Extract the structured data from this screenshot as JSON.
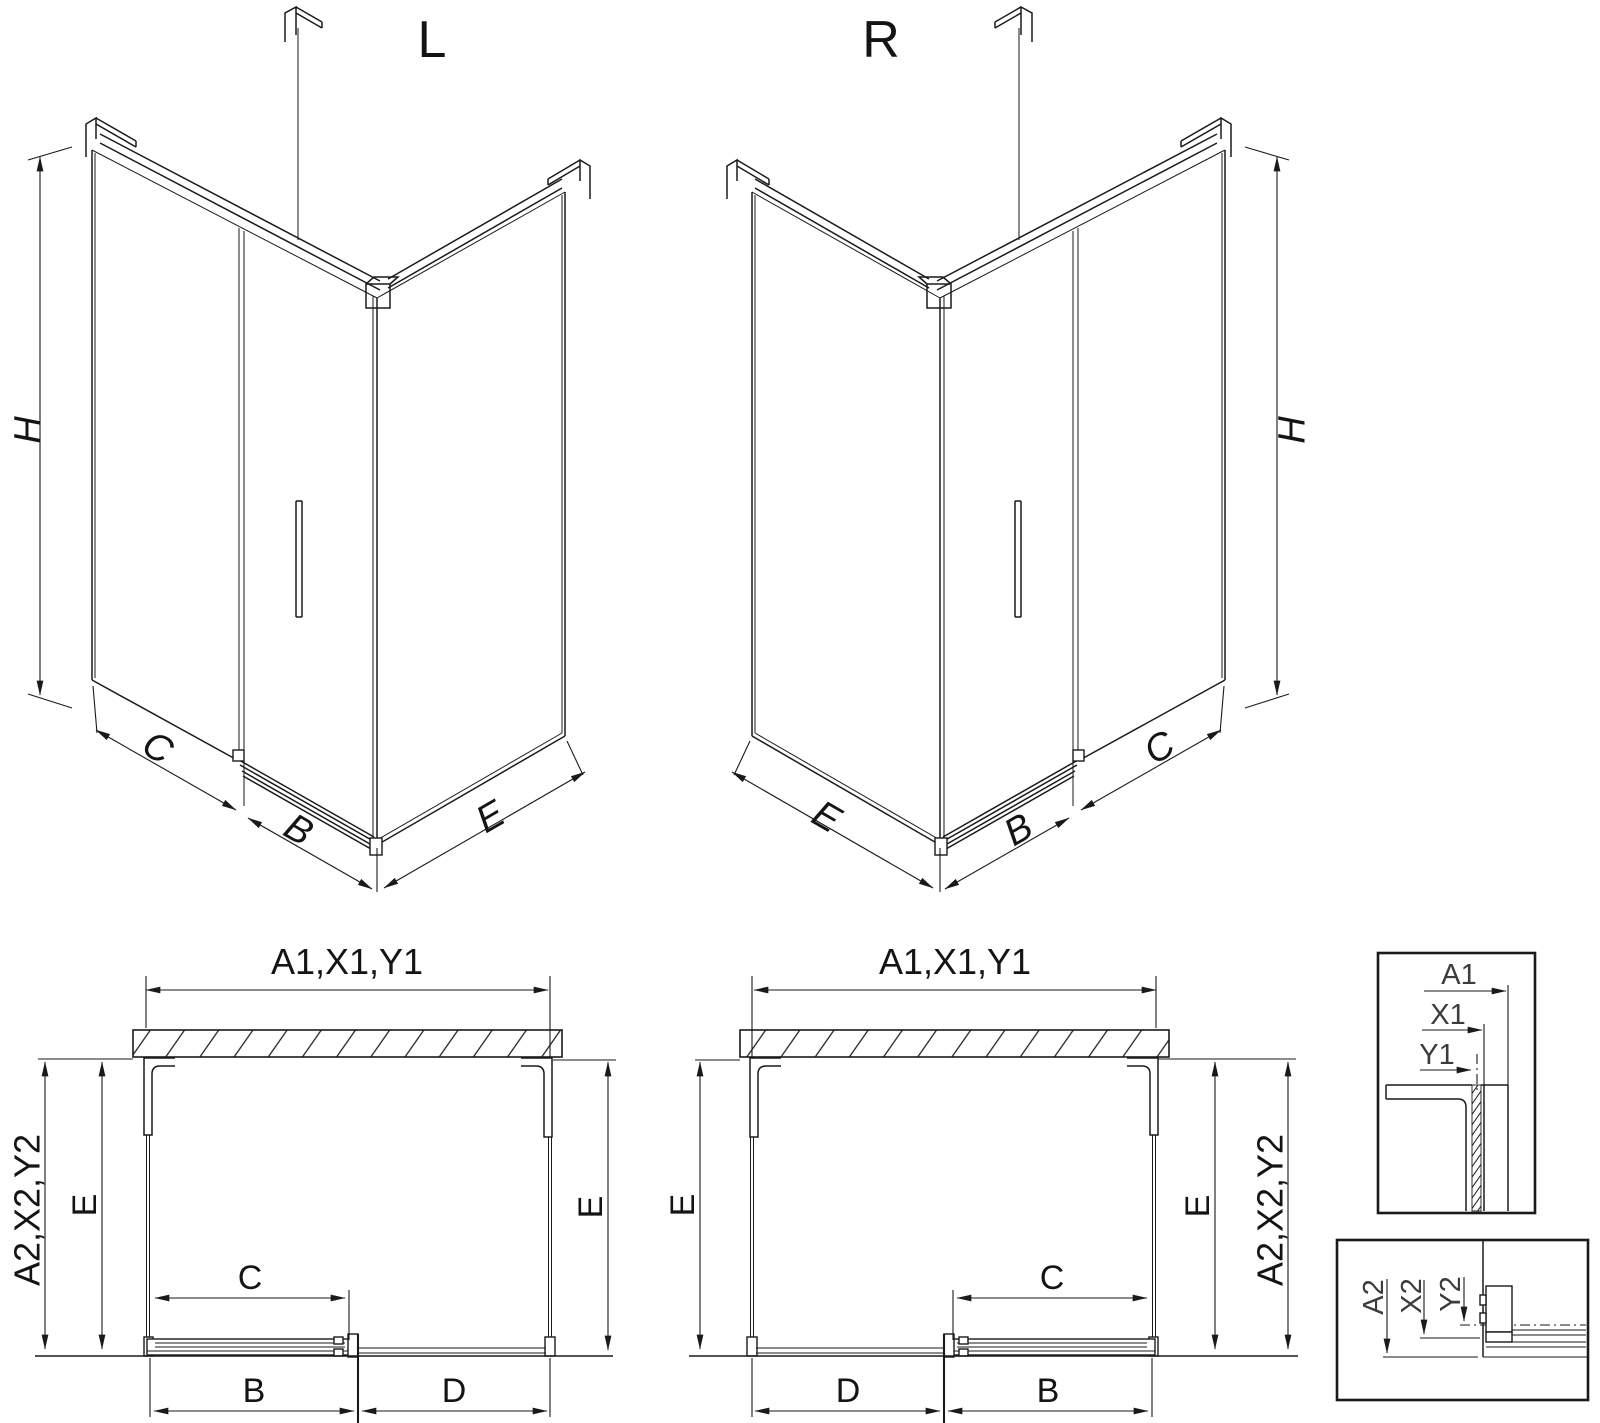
{
  "drawing": {
    "iso_left": {
      "label": "L",
      "h": "H",
      "c": "C",
      "b": "B",
      "e": "E"
    },
    "iso_right": {
      "label": "R",
      "h": "H",
      "c": "C",
      "b": "B",
      "e": "E"
    },
    "plan_left": {
      "width": "A1,X1,Y1",
      "side": "A2,X2,Y2",
      "e_left": "E",
      "e_right": "E",
      "c": "C",
      "b": "B",
      "d": "D"
    },
    "plan_right": {
      "width": "A1,X1,Y1",
      "side": "A2,X2,Y2",
      "e_left": "E",
      "e_right": "E",
      "c": "C",
      "b": "B",
      "d": "D"
    },
    "detail_top": {
      "a": "A1",
      "x": "X1",
      "y": "Y1"
    },
    "detail_bottom": {
      "a": "A2",
      "x": "X2",
      "y": "Y2"
    }
  }
}
